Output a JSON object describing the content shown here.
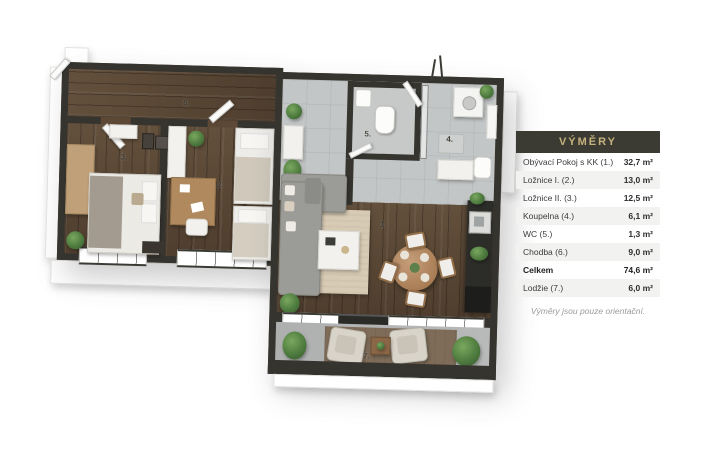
{
  "legend": {
    "title": "VÝMĚRY",
    "rows": [
      {
        "label": "Obývací Pokoj s KK (1.)",
        "value": "32,7 m²"
      },
      {
        "label": "Ložnice I. (2.)",
        "value": "13,0 m²"
      },
      {
        "label": "Ložnice II. (3.)",
        "value": "12,5 m²"
      },
      {
        "label": "Koupelna (4.)",
        "value": "6,1 m²"
      },
      {
        "label": "WC (5.)",
        "value": "1,3 m²"
      },
      {
        "label": "Chodba (6.)",
        "value": "9,0 m²"
      },
      {
        "label": "Celkem",
        "value": "74,6 m²",
        "emphasis": true
      },
      {
        "label": "Lodžie (7.)",
        "value": "6,0 m²"
      }
    ],
    "footnote": "Výměry jsou pouze orientační.",
    "colors": {
      "header_bg": "#3b3a33",
      "header_text": "#c6b27e",
      "row_alt_bg": "#f2f2f0",
      "label_text": "#3b3b3b",
      "footnote_text": "#9b9b98"
    }
  },
  "floorplan": {
    "labels": [
      {
        "room": "obyvaci-pokoj-s-kk",
        "text": "1."
      },
      {
        "room": "loznice-i",
        "text": "2."
      },
      {
        "room": "loznice-ii",
        "text": "3."
      },
      {
        "room": "koupelna",
        "text": "4."
      },
      {
        "room": "wc",
        "text": "5."
      },
      {
        "room": "chodba",
        "text": "6."
      },
      {
        "room": "lodzie",
        "text": "7."
      }
    ],
    "colors": {
      "wall": "#35342f",
      "wood_floor": "#5d4836",
      "tile_floor": "#c3c6c6",
      "balcony_floor": "#b2b4b3",
      "rug_living": "#d8cbb4",
      "rug_balcony": "#7e6c59",
      "sofa": "#9b9b97",
      "dining_table": "#b08358",
      "plant": "#4e7b3f"
    }
  }
}
